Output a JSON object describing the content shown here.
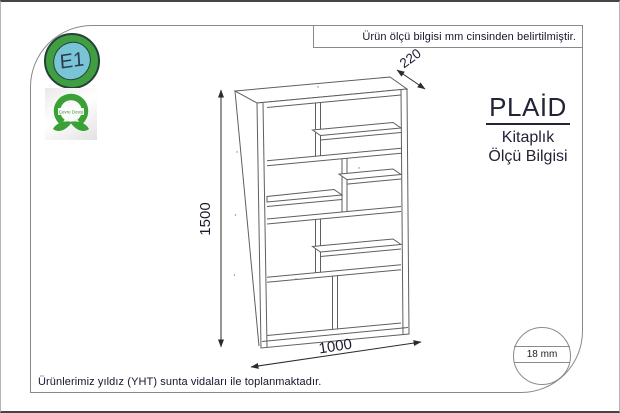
{
  "frame": {
    "top_note": "Ürün ölçü bilgisi mm cinsinden belirtilmiştir.",
    "bottom_note": "Ürünlerimiz yıldız (YHT) sunta vidaları ile toplanmaktadır."
  },
  "logos": {
    "e1_label": "E1",
    "eco_label": "Çevre Dostu"
  },
  "product": {
    "brand": "PLAİD",
    "category": "Kitaplık",
    "info_label": "Ölçü Bilgisi"
  },
  "dimensions": {
    "height_mm": "1500",
    "width_mm": "1000",
    "depth_mm": "220",
    "thickness_label": "18 mm"
  },
  "colors": {
    "line": "#5f5f5f",
    "accent_green": "#3aa235",
    "e1_blue": "#79c5d6",
    "text": "#1c1c30"
  }
}
